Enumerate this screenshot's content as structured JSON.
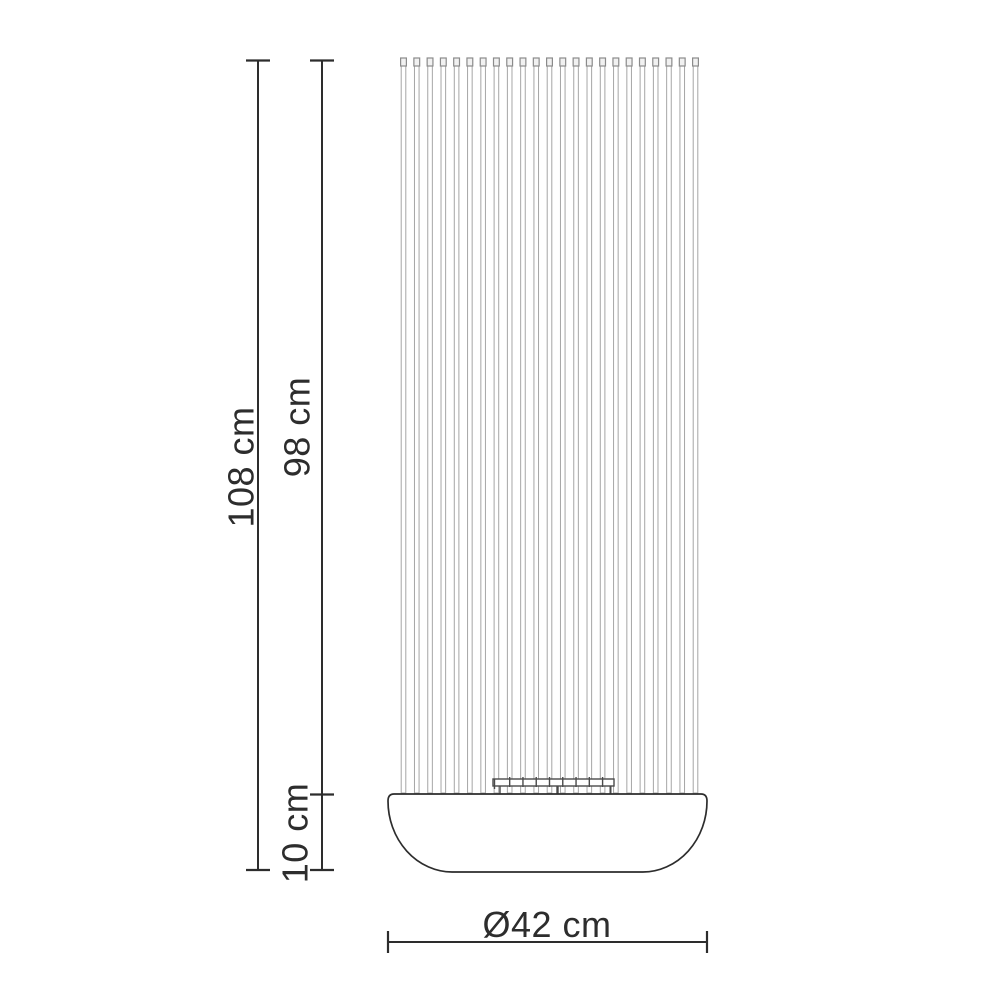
{
  "diagram": {
    "title": "Floor lamp dimension drawing",
    "labels": {
      "total_height": "108 cm",
      "shade_height": "98 cm",
      "base_height": "10 cm",
      "base_diameter": "Ø42 cm"
    },
    "rods": {
      "count": 23
    },
    "colors": {
      "line": "#2d2d2d",
      "rod": "#a6a6a6",
      "rod_cap": "#8b8b8b",
      "bracket": "#4a4a4a",
      "background": "#ffffff"
    }
  }
}
